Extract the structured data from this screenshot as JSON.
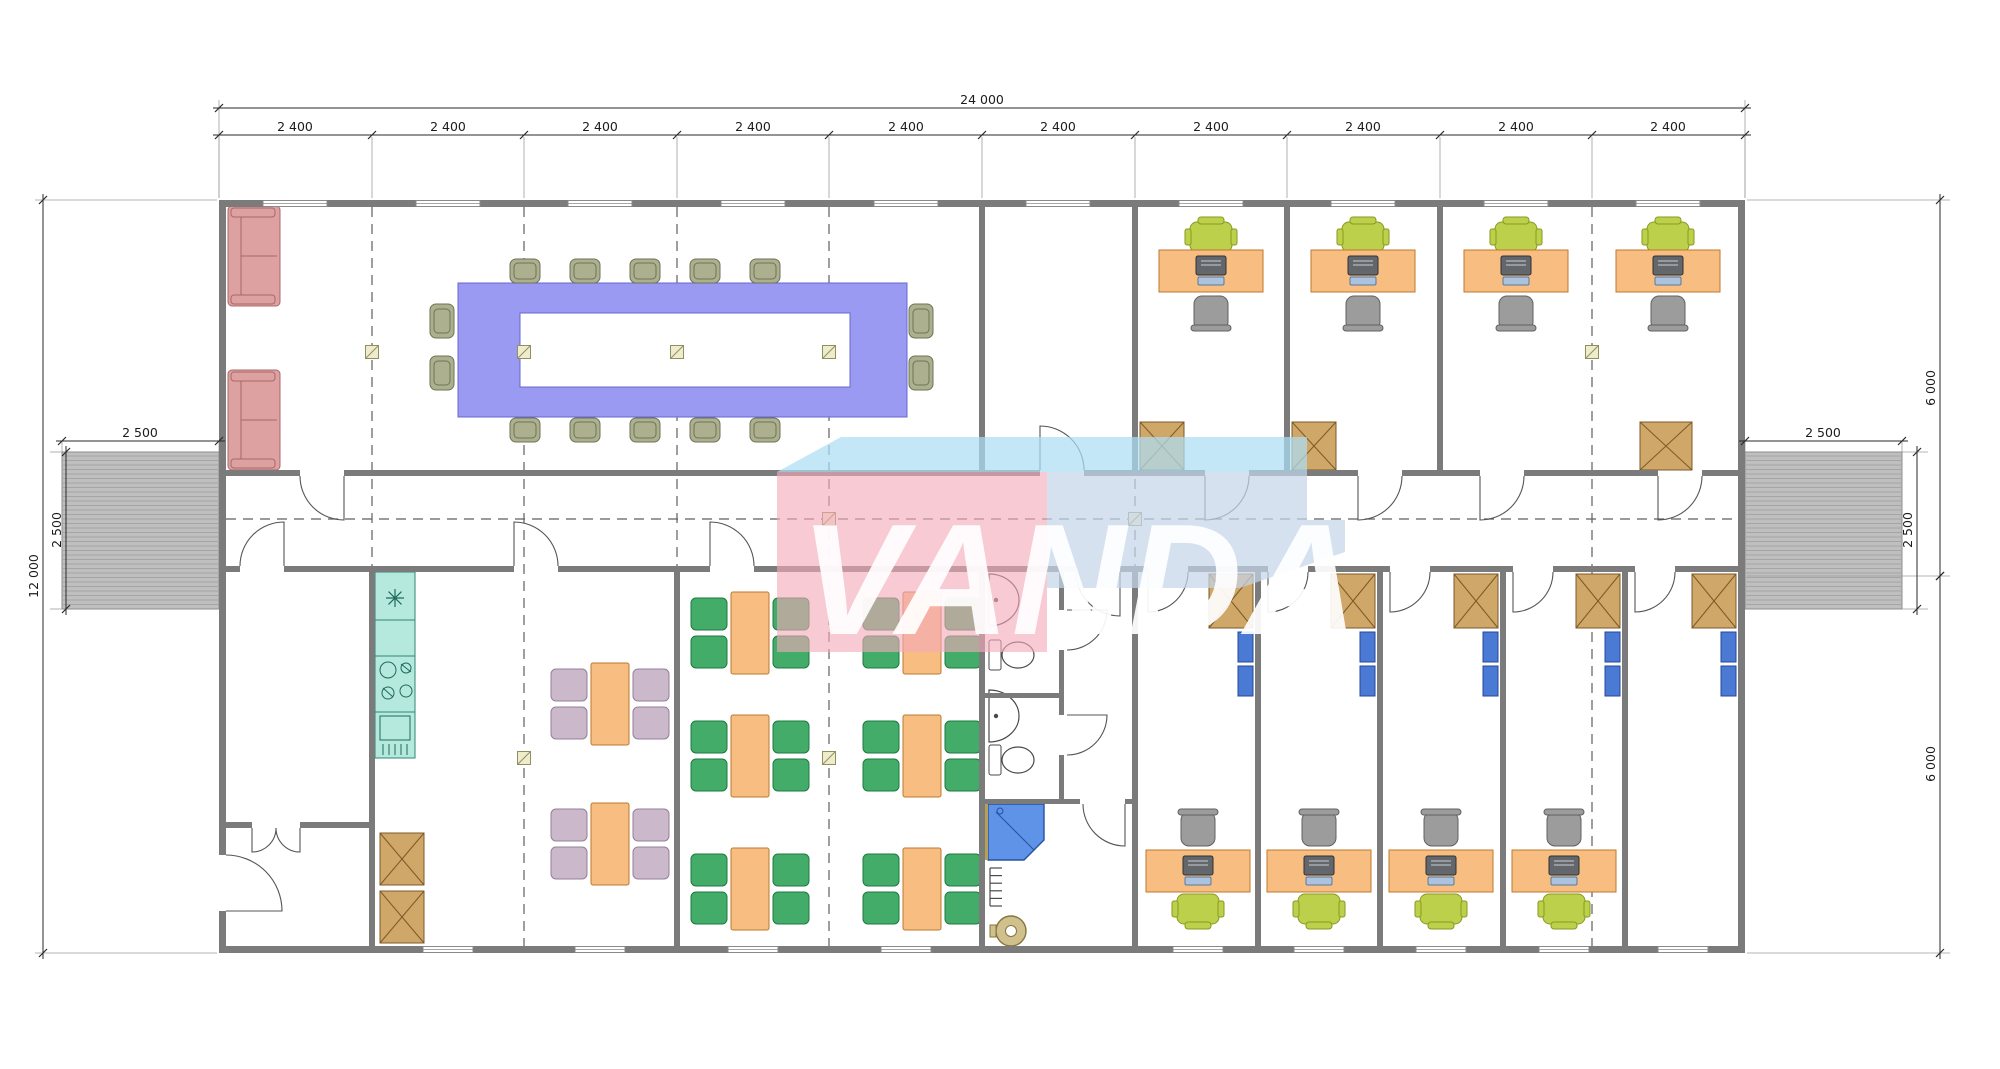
{
  "watermark": {
    "text": "VANDA",
    "pink": "rgba(244,170,186,0.62)",
    "blue_band": "rgba(173,222,244,0.72)",
    "blue_block": "rgba(198,213,233,0.72)",
    "letter_color": "rgba(255,255,255,0.92)",
    "poly_band": "777,472 841,437 1307,437 1307,472",
    "poly_block": "1047,472 1307,472 1307,520 1345,520 1345,552 1240,588 1047,588",
    "poly_pink": "777,472 1047,472 1047,652 777,652"
  },
  "dims": [
    {
      "id": "total-width",
      "type": "h",
      "y": 108,
      "x1": 219,
      "x2": 1745,
      "ticks": [
        219,
        1745
      ],
      "labels": [
        {
          "text": "24 000",
          "x": 982
        }
      ]
    },
    {
      "id": "bays",
      "type": "h",
      "y": 135,
      "x1": 219,
      "x2": 1745,
      "ticks": [
        219,
        372,
        524,
        677,
        829,
        982,
        1135,
        1287,
        1440,
        1592,
        1745
      ],
      "labels": [
        {
          "text": "2 400",
          "x": 295
        },
        {
          "text": "2 400",
          "x": 448
        },
        {
          "text": "2 400",
          "x": 600
        },
        {
          "text": "2 400",
          "x": 753
        },
        {
          "text": "2 400",
          "x": 906
        },
        {
          "text": "2 400",
          "x": 1058
        },
        {
          "text": "2 400",
          "x": 1211
        },
        {
          "text": "2 400",
          "x": 1363
        },
        {
          "text": "2 400",
          "x": 1516
        },
        {
          "text": "2 400",
          "x": 1668
        }
      ]
    },
    {
      "id": "total-height",
      "type": "v",
      "x": 43,
      "y1": 200,
      "y2": 953,
      "ticks": [
        200,
        953
      ],
      "labels": [
        {
          "text": "12 000",
          "y": 576
        }
      ]
    },
    {
      "id": "ramp-left-v",
      "type": "v",
      "x": 66,
      "y1": 452,
      "y2": 609,
      "ticks": [
        452,
        609
      ],
      "labels": [
        {
          "text": "2 500",
          "y": 530
        }
      ]
    },
    {
      "id": "ramp-left-h",
      "type": "h",
      "y": 441,
      "x1": 62,
      "x2": 219,
      "ticks": [
        62,
        219
      ],
      "labels": [
        {
          "text": "2 500",
          "x": 140
        }
      ]
    },
    {
      "id": "right-top",
      "type": "v",
      "x": 1940,
      "y1": 200,
      "y2": 576,
      "ticks": [
        200,
        576
      ],
      "labels": [
        {
          "text": "6 000",
          "y": 388
        }
      ]
    },
    {
      "id": "right-bottom",
      "type": "v",
      "x": 1940,
      "y1": 576,
      "y2": 953,
      "ticks": [
        576,
        953
      ],
      "labels": [
        {
          "text": "6 000",
          "y": 764
        }
      ]
    },
    {
      "id": "ramp-right-v",
      "type": "v",
      "x": 1917,
      "y1": 452,
      "y2": 609,
      "ticks": [
        452,
        609
      ],
      "labels": [
        {
          "text": "2 500",
          "y": 530
        }
      ]
    },
    {
      "id": "ramp-right-h",
      "type": "h",
      "y": 441,
      "x1": 1745,
      "x2": 1902,
      "ticks": [
        1745,
        1902
      ],
      "labels": [
        {
          "text": "2 500",
          "x": 1823
        }
      ]
    }
  ],
  "plan": {
    "colors": {
      "wall": "#7b7b7b",
      "dash": "#5f5f5f",
      "dim": "#2a2a2a",
      "ext": "#9d9d9d",
      "ramp_base": "#bfbfbf",
      "ramp_line": "#a5a5a5",
      "ramp_edge": "#8c8c8c",
      "sofa": "#dda1a1",
      "sofa_s": "#a96868",
      "conf": "#9a9af2",
      "conf_s": "#6667cf",
      "chair_olive": "#acb08f",
      "chair_olive_s": "#6e7356",
      "desk": "#f8bd81",
      "desk_s": "#bd7930",
      "exec": "#bdd04c",
      "exec_s": "#879a1e",
      "gray_chair": "#9c9c9c",
      "gray_chair_s": "#606060",
      "monitor": "#63676b",
      "monitor_s": "#2f3336",
      "kb": "#abc3de",
      "kb_s": "#5a7a9a",
      "cabinet": "#cfa768",
      "cabinet_s": "#7d5a28",
      "shelf": "#4a7ad4",
      "shelf_s": "#26479c",
      "chair_green": "#43ac69",
      "chair_green_s": "#1e7a42",
      "chair_pink": "#cbb9cb",
      "chair_pink_s": "#93809a",
      "kitchen": "#b5e9de",
      "kitchen_s": "#2e8676",
      "fixture_s": "#4a4a4a",
      "shower": "#5f93e8",
      "shower_s": "#26529e",
      "heater": "#cfc08c",
      "heater_s": "#857540",
      "column_f": "#efeccb",
      "column_s": "#8f8f62",
      "window_s": "#8a8a8a"
    },
    "walls": [
      [
        219,
        200,
        1526,
        7
      ],
      [
        219,
        946,
        1526,
        7
      ],
      [
        219,
        200,
        7,
        655
      ],
      [
        219,
        911,
        7,
        42
      ],
      [
        1738,
        200,
        7,
        753
      ],
      [
        226,
        470,
        74,
        6
      ],
      [
        344,
        470,
        696,
        6
      ],
      [
        1084,
        470,
        121,
        6
      ],
      [
        1249,
        470,
        109,
        6
      ],
      [
        1402,
        470,
        78,
        6
      ],
      [
        1524,
        470,
        134,
        6
      ],
      [
        1702,
        470,
        36,
        6
      ],
      [
        226,
        566,
        14,
        6
      ],
      [
        284,
        566,
        230,
        6
      ],
      [
        558,
        566,
        152,
        6
      ],
      [
        754,
        566,
        322,
        6
      ],
      [
        1120,
        566,
        28,
        6
      ],
      [
        1188,
        566,
        80,
        6
      ],
      [
        1308,
        566,
        82,
        6
      ],
      [
        1430,
        566,
        83,
        6
      ],
      [
        1553,
        566,
        82,
        6
      ],
      [
        1675,
        566,
        63,
        6
      ],
      [
        979,
        207,
        6,
        263
      ],
      [
        1132,
        207,
        6,
        263
      ],
      [
        1284,
        207,
        6,
        263
      ],
      [
        1437,
        207,
        6,
        263
      ],
      [
        369,
        572,
        6,
        374
      ],
      [
        674,
        572,
        6,
        374
      ],
      [
        979,
        572,
        6,
        374
      ],
      [
        1132,
        572,
        6,
        374
      ],
      [
        1255,
        572,
        6,
        374
      ],
      [
        1377,
        572,
        6,
        374
      ],
      [
        1500,
        572,
        6,
        374
      ],
      [
        1622,
        572,
        6,
        374
      ],
      [
        226,
        822,
        26,
        6
      ],
      [
        300,
        822,
        69,
        6
      ],
      [
        1059,
        572,
        5,
        38
      ],
      [
        1059,
        650,
        5,
        65
      ],
      [
        1059,
        755,
        5,
        47
      ],
      [
        985,
        693,
        74,
        5
      ],
      [
        985,
        799,
        95,
        5
      ],
      [
        1125,
        799,
        10,
        5
      ]
    ],
    "ramps": [
      [
        62,
        452,
        157,
        157
      ],
      [
        1745,
        452,
        157,
        157
      ]
    ],
    "dashed_v": [
      {
        "x": 372
      },
      {
        "x": 524
      },
      {
        "x": 677
      },
      {
        "x": 829
      },
      {
        "x": 1135
      },
      {
        "x": 1592
      }
    ],
    "dashed_y1": 207,
    "dashed_y2": 946,
    "dashed_h": [
      {
        "y": 519,
        "x1": 226,
        "x2": 1738
      }
    ],
    "grid_ext": [
      219,
      372,
      524,
      677,
      829,
      982,
      1135,
      1287,
      1440,
      1592,
      1745
    ],
    "ext_lines": [
      [
        219,
        100,
        219,
        198
      ],
      [
        1745,
        100,
        1745,
        198
      ],
      [
        35,
        200,
        217,
        200
      ],
      [
        35,
        953,
        217,
        953
      ],
      [
        1747,
        200,
        1950,
        200
      ],
      [
        1747,
        953,
        1950,
        953
      ],
      [
        1747,
        576,
        1950,
        576
      ],
      [
        62,
        441,
        62,
        452
      ],
      [
        219,
        441,
        219,
        452
      ],
      [
        1745,
        441,
        1745,
        452
      ],
      [
        1902,
        441,
        1902,
        452
      ],
      [
        50,
        452,
        62,
        452
      ],
      [
        50,
        609,
        62,
        609
      ],
      [
        1902,
        452,
        1928,
        452
      ],
      [
        1902,
        609,
        1928,
        609
      ]
    ],
    "windows_top": [
      295,
      448,
      600,
      753,
      906,
      1058,
      1211,
      1363,
      1516,
      1668
    ],
    "windows_bottom": [
      448,
      600,
      753,
      906,
      1198,
      1319,
      1441,
      1564,
      1683
    ],
    "doors": [
      "M344,476 L344,520 A44,44 0 0 1 300,476",
      "M1040,470 L1040,426 A44,44 0 0 1 1084,470",
      "M1205,476 L1205,520 A44,44 0 0 0 1249,476",
      "M1358,476 L1358,520 A44,44 0 0 0 1402,476",
      "M1480,476 L1480,520 A44,44 0 0 0 1524,476",
      "M1658,476 L1658,520 A44,44 0 0 0 1702,476",
      "M284,566 L284,522 A44,44 0 0 0 240,566",
      "M514,566 L514,522 A44,44 0 0 1 558,566",
      "M710,566 L710,522 A44,44 0 0 1 754,566",
      "M1120,572 L1120,616 A44,44 0 0 1 1076,572",
      "M1148,572 L1148,612 A40,40 0 0 0 1188,572",
      "M1268,572 L1268,612 A40,40 0 0 0 1308,572",
      "M1390,572 L1390,612 A40,40 0 0 0 1430,572",
      "M1513,572 L1513,612 A40,40 0 0 0 1553,572",
      "M1635,572 L1635,612 A40,40 0 0 0 1675,572",
      "M226,911 L282,911 A56,56 0 0 0 226,855",
      "M252,828 L252,852 A24,24 0 0 0 276,828",
      "M300,828 L300,852 A24,24 0 0 1 276,828",
      "M1067,610 L1107,610 A40,40 0 0 1 1067,650",
      "M1067,715 L1107,715 A40,40 0 0 1 1067,755",
      "M1125,804 L1125,846 A42,42 0 0 1 1083,804"
    ],
    "columns": [
      [
        372,
        352
      ],
      [
        524,
        352
      ],
      [
        677,
        352
      ],
      [
        829,
        352
      ],
      [
        1592,
        352
      ],
      [
        829,
        519
      ],
      [
        1135,
        519
      ],
      [
        524,
        758
      ],
      [
        829,
        758
      ]
    ],
    "sofas": [
      [
        228,
        206,
        52,
        100
      ],
      [
        228,
        370,
        52,
        100
      ]
    ],
    "conference": {
      "outer": [
        458,
        283,
        449,
        134
      ],
      "inner": [
        520,
        313,
        330,
        74
      ],
      "chairs_h": [
        [
          510,
          259
        ],
        [
          570,
          259
        ],
        [
          630,
          259
        ],
        [
          690,
          259
        ],
        [
          750,
          259
        ],
        [
          510,
          418
        ],
        [
          570,
          418
        ],
        [
          630,
          418
        ],
        [
          690,
          418
        ],
        [
          750,
          418
        ]
      ],
      "chairs_v": [
        [
          430,
          304
        ],
        [
          430,
          356
        ],
        [
          909,
          304
        ],
        [
          909,
          356
        ]
      ]
    },
    "desks_top": [
      1211,
      1363,
      1516,
      1668
    ],
    "desks_bottom": [
      1198,
      1319,
      1441,
      1564
    ],
    "cabinets": [
      [
        1140,
        422,
        44,
        48
      ],
      [
        1292,
        422,
        44,
        48
      ],
      [
        1640,
        422,
        52,
        48
      ],
      [
        1209,
        574,
        44,
        54
      ],
      [
        1331,
        574,
        44,
        54
      ],
      [
        1454,
        574,
        44,
        54
      ],
      [
        1576,
        574,
        44,
        54
      ],
      [
        1692,
        574,
        44,
        54
      ],
      [
        380,
        833,
        44,
        52
      ],
      [
        380,
        891,
        44,
        52
      ]
    ],
    "blue_shelves": [
      [
        1238,
        632
      ],
      [
        1238,
        666
      ],
      [
        1360,
        632
      ],
      [
        1360,
        666
      ],
      [
        1483,
        632
      ],
      [
        1483,
        666
      ],
      [
        1605,
        632
      ],
      [
        1605,
        666
      ],
      [
        1721,
        632
      ],
      [
        1721,
        666
      ]
    ],
    "tables": [
      {
        "x": 591,
        "y": 663,
        "c": "pink"
      },
      {
        "x": 591,
        "y": 803,
        "c": "pink"
      },
      {
        "x": 731,
        "y": 592,
        "c": "green"
      },
      {
        "x": 731,
        "y": 715,
        "c": "green"
      },
      {
        "x": 731,
        "y": 848,
        "c": "green"
      },
      {
        "x": 903,
        "y": 592,
        "c": "green"
      },
      {
        "x": 903,
        "y": 715,
        "c": "green"
      },
      {
        "x": 903,
        "y": 848,
        "c": "green"
      }
    ],
    "kitchen": {
      "x": 375,
      "y": 572,
      "w": 40,
      "h": 186,
      "sections": [
        620,
        656,
        712
      ]
    },
    "wc": {
      "sinks": [
        [
          989,
          600
        ],
        [
          989,
          716
        ]
      ],
      "toilets": [
        [
          989,
          640
        ],
        [
          989,
          745
        ]
      ],
      "shower_poly": "988,804 1044,804 1044,840 1024,860 988,860",
      "heater": [
        1011,
        931
      ],
      "radiator": [
        990,
        868
      ]
    }
  }
}
